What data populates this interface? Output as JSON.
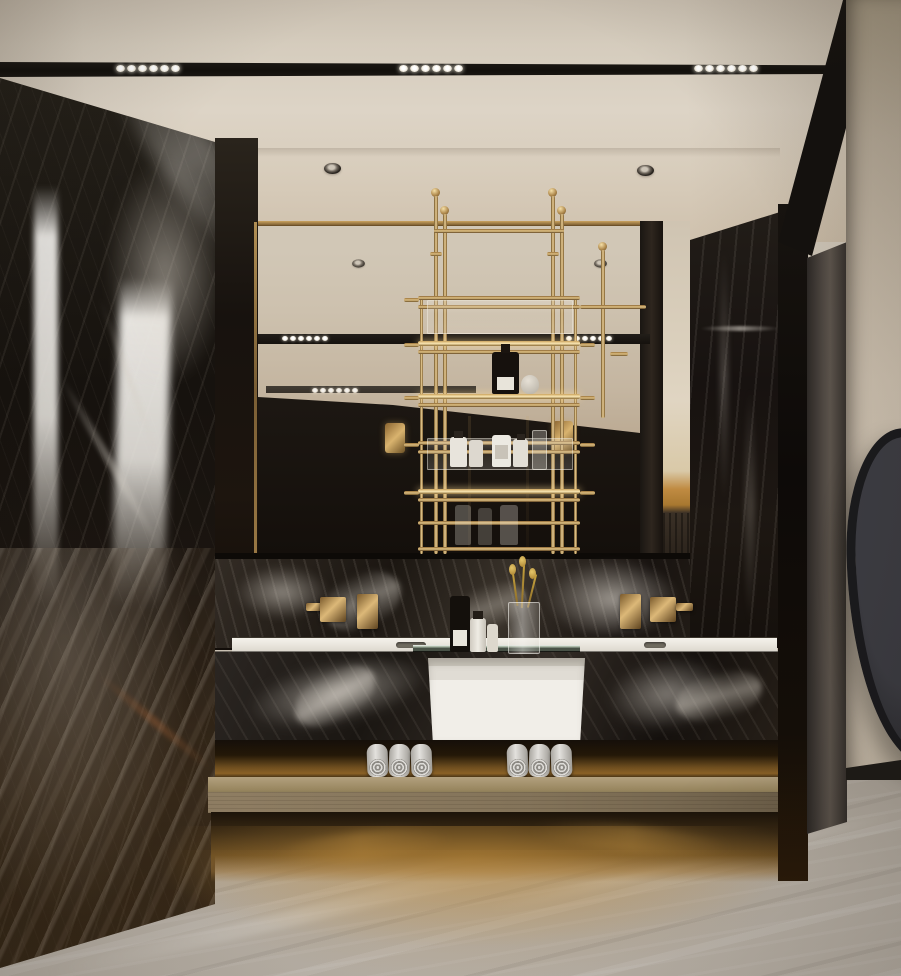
{
  "scene": {
    "description": "Luxury modern bathroom rendering: black veined marble walls, brass hanging shelf rack with cosmetics, mirrored vanity wall with two wall-mounted brass faucets, central white vessel basin, backlit towel shelf with rolled towels, grey marble floor and an organic-shaped dark wall mirror on the right",
    "room_type": "bathroom",
    "style": "modern luxury",
    "materials": [
      "black veined marble",
      "brass",
      "mirror glass",
      "wood",
      "grey marble floor"
    ]
  },
  "palette": {
    "ceiling": "#d8cfc1",
    "track_black": "#15120e",
    "light_dot": "#f6f3ec",
    "marble_dark": "#1c1815",
    "marble_vein": "#cfc8bf",
    "brass": "#b68c4e",
    "brass_bright": "#ecd096",
    "mirror_cream": "#ccc0ae",
    "counter_white": "#f1eee8",
    "wood_shelf": "#8c7b60",
    "floor_grey": "#b2aa9f",
    "glow_warm": "#b98a3f",
    "wall_right": "#c6b9a7",
    "pillar_grey": "#4e4842",
    "organic_mirror": "#2a2a2e",
    "towel_grey": "#d3d1cd"
  },
  "ceiling": {
    "track_light": {
      "bar_y": 62,
      "bar_width": 833,
      "groups": 3,
      "dots_per_group": 6,
      "group_positions_x": [
        116,
        399,
        694
      ]
    },
    "recessed_spotlights": [
      {
        "x": 324,
        "y": 163
      },
      {
        "x": 637,
        "y": 165
      }
    ]
  },
  "mirror": {
    "dots_per_group": 6,
    "reflected_spotlights": [
      {
        "x": 92,
        "y": 37
      },
      {
        "x": 334,
        "y": 37
      }
    ],
    "track_reflections": [
      {
        "left": 0,
        "top": 113,
        "width": 392,
        "height": 10,
        "opacity": 1,
        "dot_groups_x": [
          24,
          308
        ]
      },
      {
        "left": 8,
        "top": 165,
        "width": 210,
        "height": 7,
        "opacity": 0.8,
        "dot_groups_x": [
          46
        ]
      }
    ],
    "brass_plates": [
      {
        "left": 127,
        "top": 202
      },
      {
        "left": 295,
        "top": 200
      }
    ]
  },
  "rack": {
    "material": "brass",
    "hanging_rods": 4,
    "shelf_rows": 6,
    "glass_shelves": 2,
    "items": [
      "black cosmetic bottle",
      "white cosmetic bottles",
      "glass atomizer"
    ]
  },
  "vanity": {
    "faucets": 2,
    "basins": 3,
    "counter_items": [
      "black perfume bottle",
      "white perfume bottle",
      "small white bottle",
      "glass vase with dried gold flowers"
    ]
  },
  "towels": {
    "rolls_per_group": 3,
    "groups": [
      {
        "x_positions": [
          152,
          174,
          196
        ]
      },
      {
        "x_positions": [
          292,
          314,
          336
        ]
      }
    ]
  },
  "decor": {
    "organic_wall_mirror": 1
  }
}
